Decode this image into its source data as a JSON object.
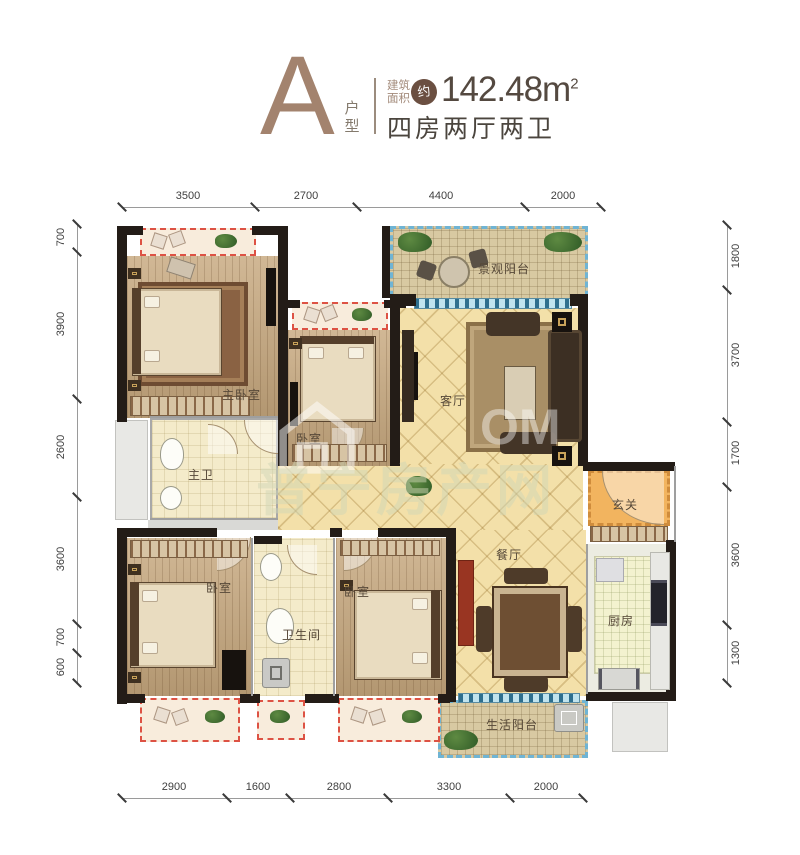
{
  "header": {
    "type_letter": "A",
    "type_label": "户型",
    "area_label_top": "建筑",
    "area_label_bottom": "面积",
    "approx_badge": "约",
    "area_value": "142.48m",
    "area_superscript": "2",
    "layout_summary": "四房两厅两卫"
  },
  "dimensions": {
    "top": [
      "3500",
      "2700",
      "4400",
      "2000"
    ],
    "bottom": [
      "2900",
      "1600",
      "2800",
      "3300",
      "2000"
    ],
    "left": [
      "700",
      "3900",
      "2600",
      "3600",
      "700",
      "600"
    ],
    "right": [
      "1800",
      "3700",
      "1700",
      "3600",
      "1300"
    ]
  },
  "rooms": [
    {
      "name": "master-bedroom",
      "label": "主卧室"
    },
    {
      "name": "bedroom-2",
      "label": "卧室"
    },
    {
      "name": "living-room",
      "label": "客厅"
    },
    {
      "name": "view-balcony",
      "label": "景观阳台"
    },
    {
      "name": "master-bathroom",
      "label": "主卫"
    },
    {
      "name": "entry-hall",
      "label": "玄关"
    },
    {
      "name": "dining-room",
      "label": "餐厅"
    },
    {
      "name": "kitchen",
      "label": "厨房"
    },
    {
      "name": "bedroom-3",
      "label": "卧室"
    },
    {
      "name": "bathroom",
      "label": "卫生间"
    },
    {
      "name": "bedroom-4",
      "label": "卧室"
    },
    {
      "name": "utility-balcony",
      "label": "生活阳台"
    }
  ],
  "watermark": {
    "site_name": "普宁房产网",
    "logo_icon": "house-icon",
    "partial_url_text": "OM"
  },
  "colors": {
    "title_brown": "#a3836e",
    "text_dark": "#4b453e",
    "wall_black": "#231c17",
    "wood_floor": "#c7a87e",
    "tile_cream": "#f3e0a9",
    "balcony_dashed_blue": "#6fb4d4",
    "bay_window_red": "#dd5244",
    "entry_orange": "#f2b45f"
  }
}
